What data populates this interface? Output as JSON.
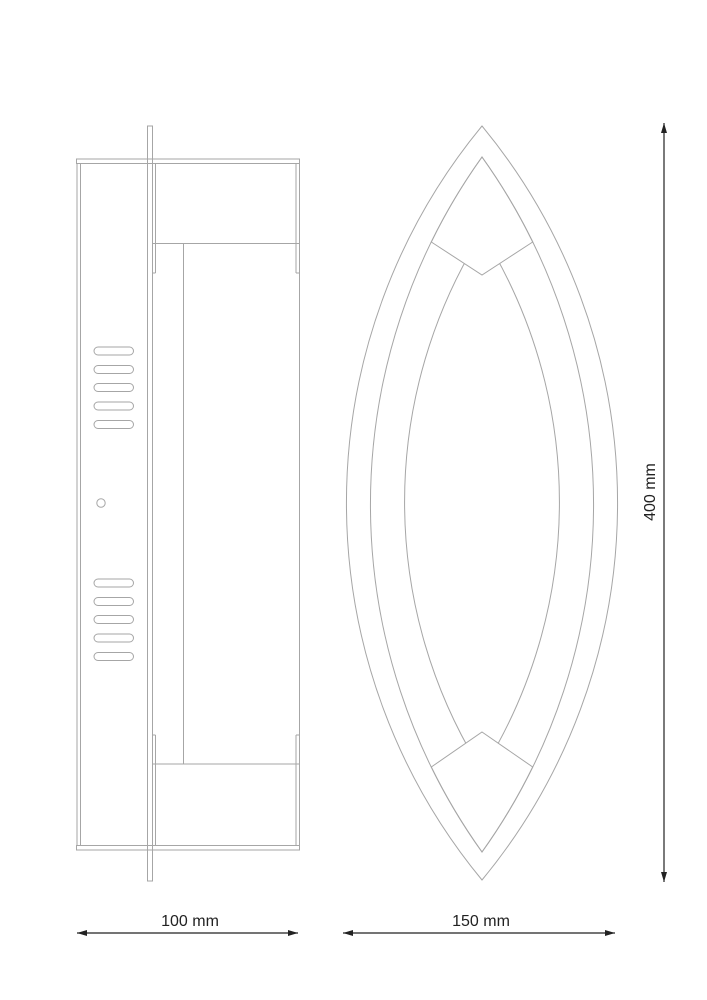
{
  "drawing": {
    "type": "technical-dimension-drawing",
    "description": "Wall lamp, side view (left) and front view (right) with marquise-shaped shade",
    "background": "#ffffff",
    "colors": {
      "outline": "#a6a6a6",
      "dimension": "#222222"
    },
    "views": [
      {
        "id": "side-view",
        "vent_slot_groups": 2,
        "slots_per_group": 5,
        "screw_holes": 1
      },
      {
        "id": "front-view",
        "nested_outlines": 3,
        "clips": 2
      }
    ],
    "dimensions": {
      "side_width": {
        "label": "100 mm",
        "value": 100,
        "unit": "mm",
        "orientation": "horizontal"
      },
      "front_width": {
        "label": "150 mm",
        "value": 150,
        "unit": "mm",
        "orientation": "horizontal"
      },
      "height": {
        "label": "400 mm",
        "value": 400,
        "unit": "mm",
        "orientation": "vertical"
      }
    }
  }
}
